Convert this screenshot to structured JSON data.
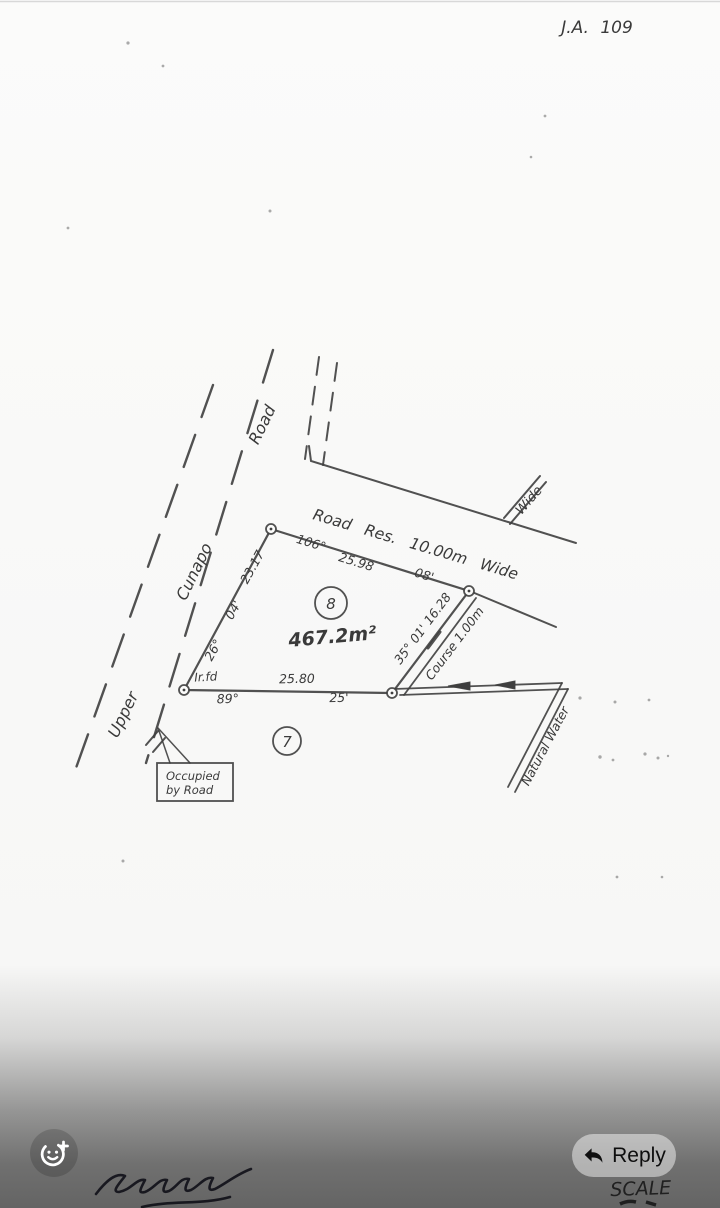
{
  "header": {
    "ref_number": "J.A. 109"
  },
  "plan": {
    "road_labels": {
      "upper": "Upper",
      "cunapo": "Cunapo",
      "road": "Road"
    },
    "road_reserve_label": "Road Res. 10.00m Wide",
    "branch_road_label": "Wide",
    "lot8": {
      "number": "8",
      "area": "467.2m²",
      "north_side": {
        "bearing_degrees": "106°",
        "distance": "25.98",
        "bearing_minutes": "08'"
      },
      "west_side": {
        "distance": "23.17",
        "bearing_minutes": "04'",
        "bearing_degrees": "26°"
      },
      "south_side": {
        "bearing_degrees": "89°",
        "distance": "25.80",
        "bearing_minutes": "25'"
      },
      "east_side": {
        "bearing_and_distance": "35° 01' 16.28"
      }
    },
    "lot7": {
      "number": "7"
    },
    "survey_marks": {
      "iron_rod_found": "Ir.fd"
    },
    "watercourse": {
      "course_width": "Course 1.00m",
      "name": "Natural Water"
    },
    "annotation_box": {
      "line1": "Occupied",
      "line2": "by Road"
    },
    "scale_heading": "SCALE"
  },
  "viewer": {
    "reply_button": "Reply"
  },
  "colors": {
    "ink": "#3a3a3a",
    "paper": "#fafaf9",
    "overlay": "rgba(15,15,15,0.63)"
  }
}
